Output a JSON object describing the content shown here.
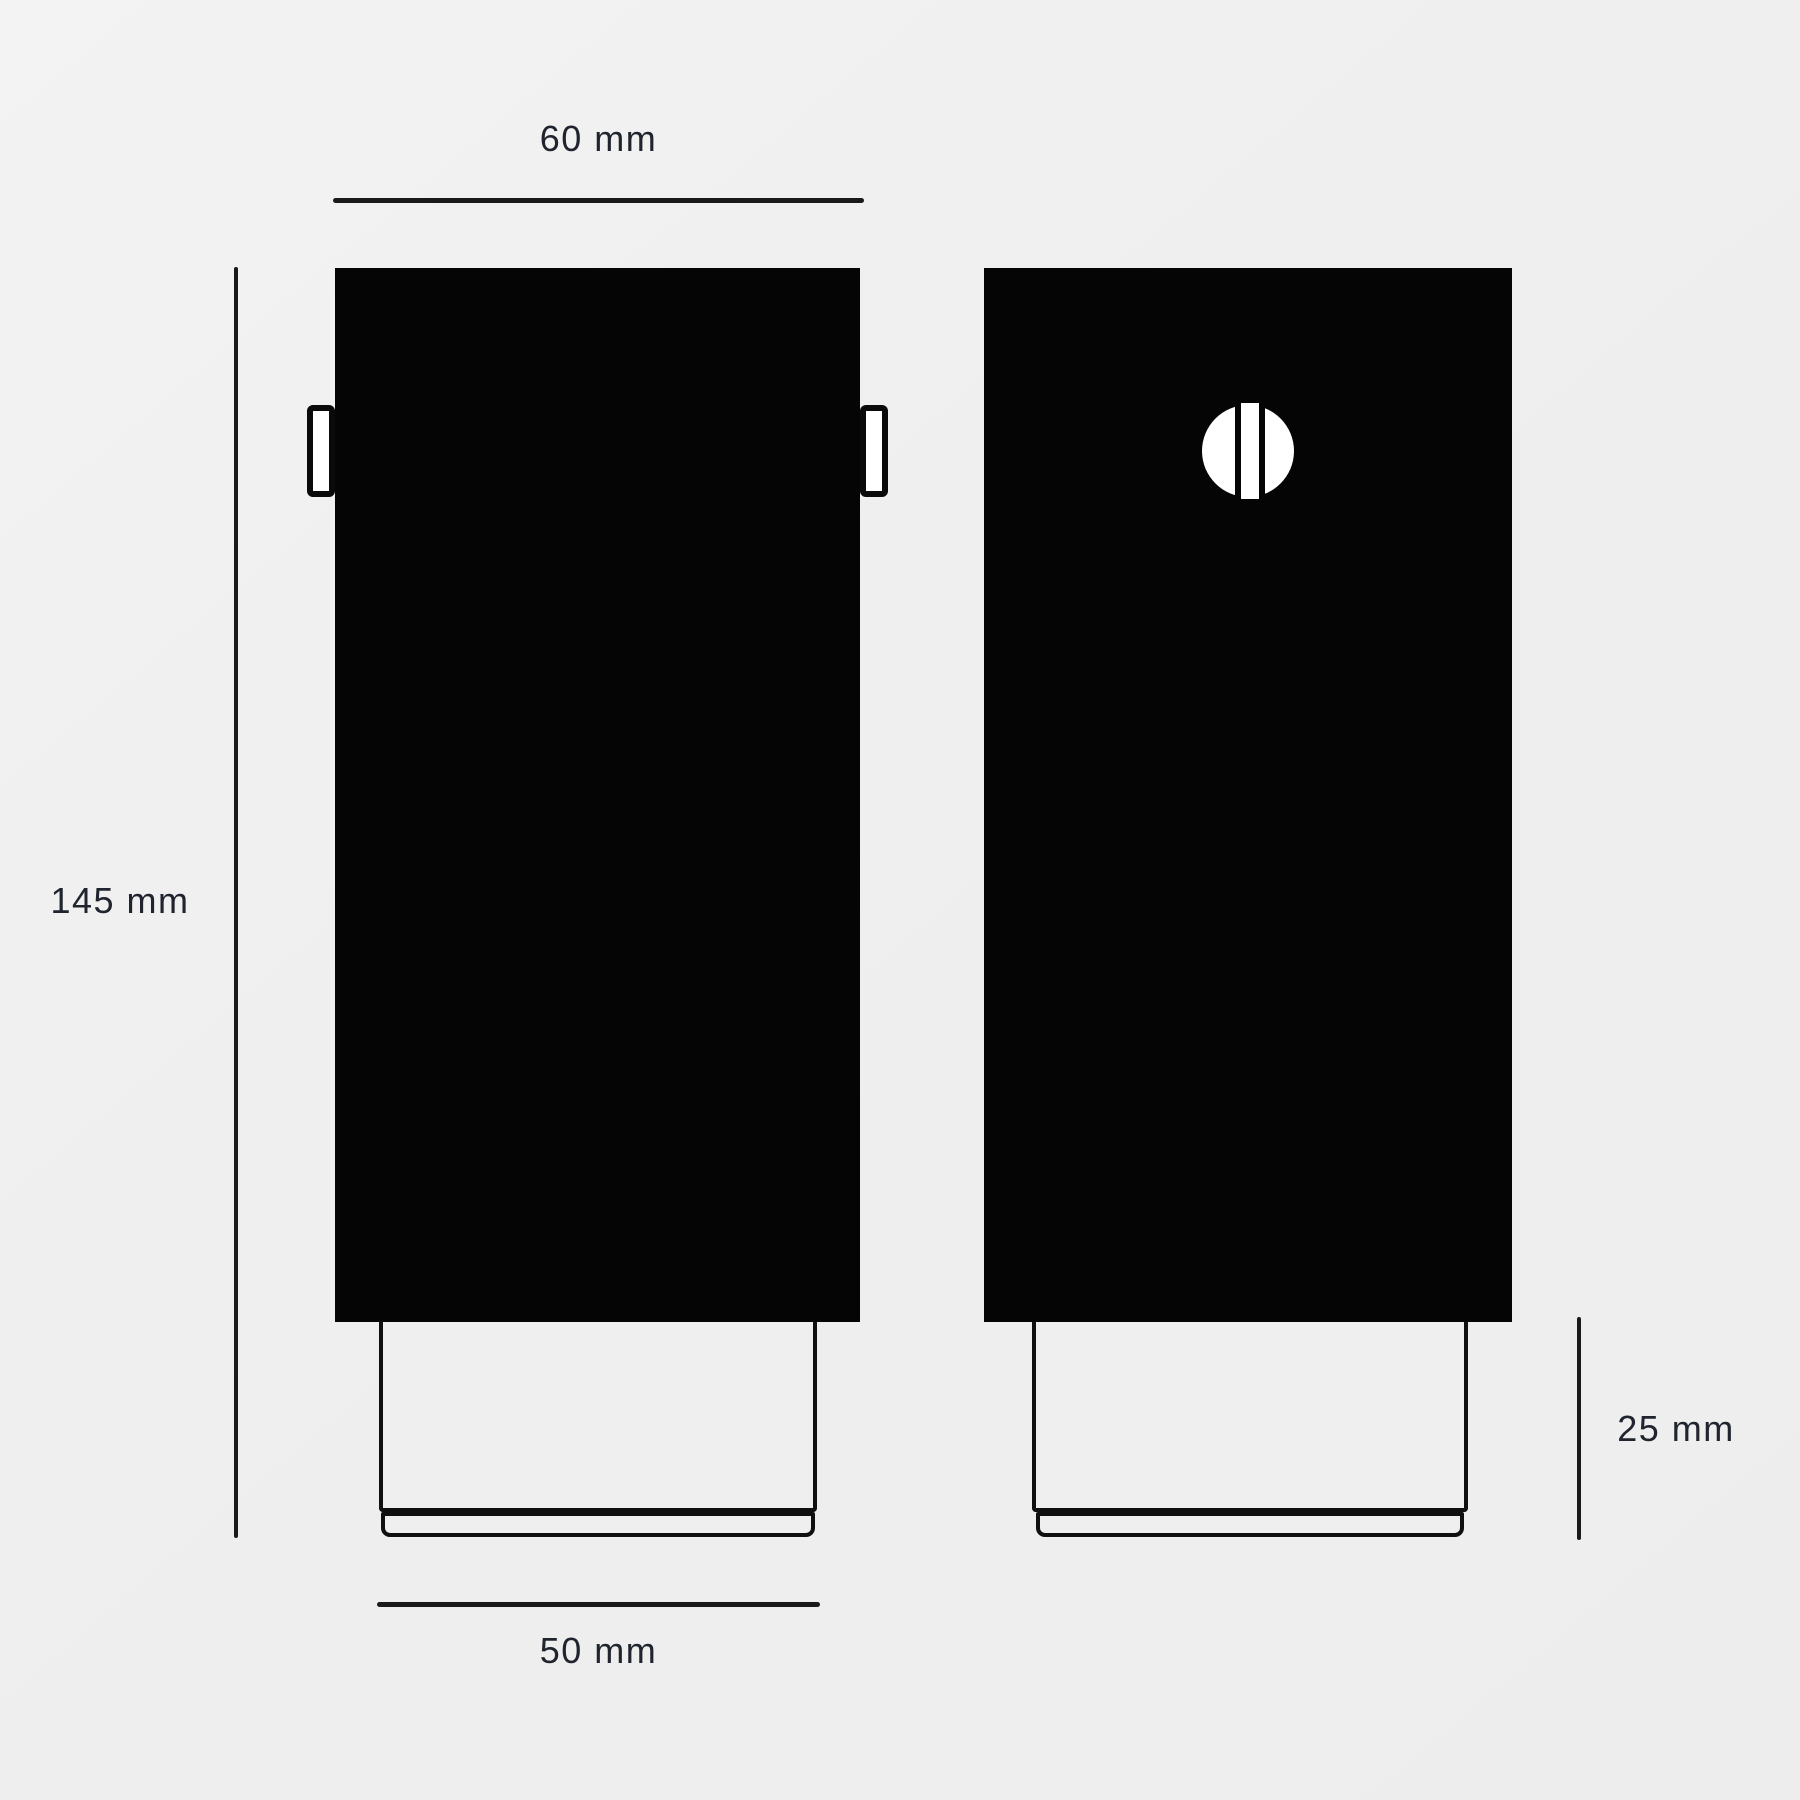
{
  "drawing": {
    "type": "technical dimension drawing, two orthographic views of a rectangular fixture with recessed base",
    "views": {
      "front": {
        "name": "front view with side mounting tabs"
      },
      "side": {
        "name": "side view with screw head"
      }
    }
  },
  "dimensions": {
    "overall_width": {
      "label": "60 mm"
    },
    "overall_height": {
      "label": "145 mm"
    },
    "base_width": {
      "label": "50 mm"
    },
    "base_height": {
      "label": "25 mm"
    }
  },
  "colors": {
    "background": "#efefef",
    "body_fill": "#050505",
    "line_ink": "#1a1a1a",
    "label_text": "#20242e",
    "screw_fill": "#ffffff"
  }
}
